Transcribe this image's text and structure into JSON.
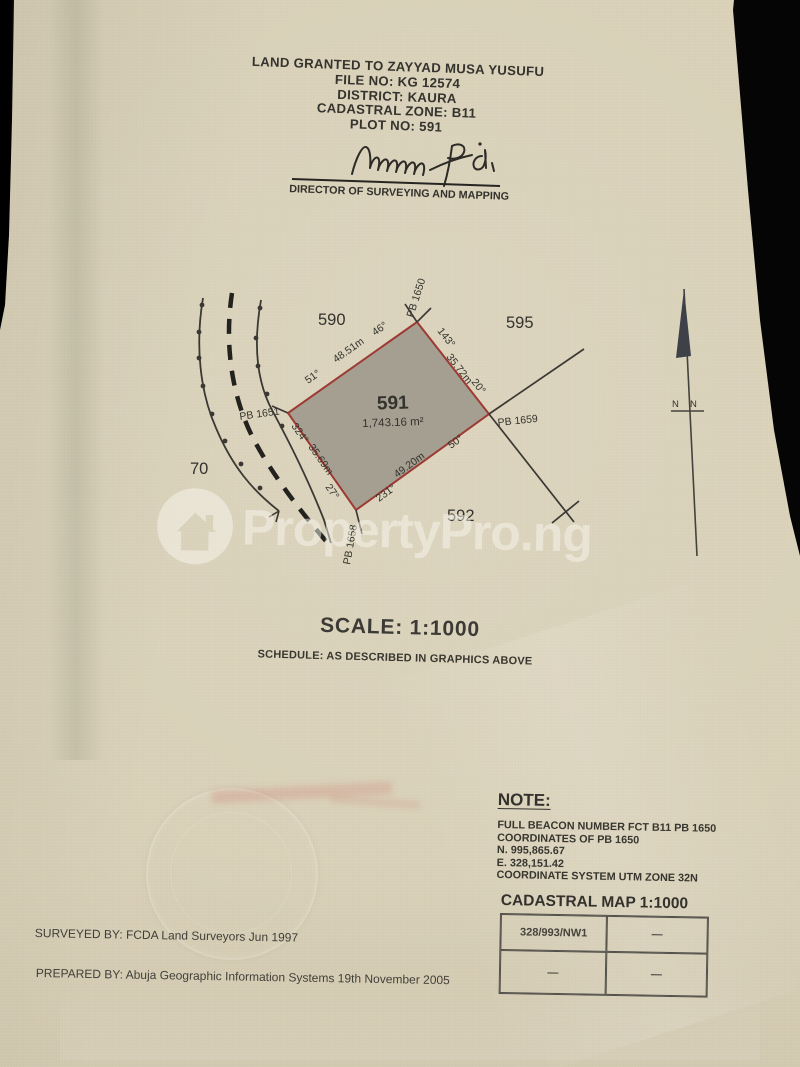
{
  "document": {
    "title_lines": [
      "LAND GRANTED TO ZAYYAD MUSA YUSUFU",
      "FILE NO: KG 12574",
      "DISTRICT: KAURA",
      "CADASTRAL ZONE: B11",
      "PLOT NO: 591"
    ],
    "signature_caption": "DIRECTOR OF SURVEYING AND MAPPING",
    "scale_label": "SCALE: 1:1000",
    "schedule_label": "SCHEDULE: AS DESCRIBED IN GRAPHICS ABOVE",
    "surveyed_by": "SURVEYED BY: FCDA Land Surveyors  Jun 1997",
    "prepared_by": "PREPARED BY: Abuja Geographic Information Systems  19th November 2005"
  },
  "plot": {
    "number": "591",
    "area": "1,743.16 m²",
    "beacons": {
      "top": "PB 1650",
      "left": "PB 1651",
      "bottom": "PB 1658",
      "right": "PB 1659"
    },
    "edges": {
      "nw": {
        "distance": "48.51m",
        "end_a": "51°",
        "end_b": "46°"
      },
      "ne": {
        "distance": "35.72m",
        "end_a": "143°",
        "end_b": "20°"
      },
      "sw": {
        "distance": "35.69m",
        "end_a": "324°",
        "end_b": "27°"
      },
      "se": {
        "distance": "49.20m",
        "end_a": "231°",
        "end_b": "50°"
      }
    },
    "neighbors": {
      "top": "590",
      "top_right": "595",
      "bottom_right": "592",
      "left": "70"
    },
    "north_left": "N",
    "north_right": "N"
  },
  "note": {
    "title": "NOTE:",
    "lines": [
      "FULL BEACON NUMBER FCT B11 PB 1650",
      "COORDINATES OF PB 1650",
      "N. 995,865.67",
      "E. 328,151.42",
      "COORDINATE SYSTEM UTM ZONE 32N"
    ]
  },
  "cadastral_map": {
    "title": "CADASTRAL MAP 1:1000",
    "cells": [
      [
        "328/993/NW1",
        "—"
      ],
      [
        "—",
        "—"
      ]
    ]
  },
  "watermark": {
    "text": "PropertyPro.ng"
  },
  "colors": {
    "paper": "#d7ceb5",
    "plot_fill": "#a59f92",
    "plot_border": "#9c3a33",
    "ink": "#2f2e2a",
    "surround": "#0d0c0a"
  }
}
